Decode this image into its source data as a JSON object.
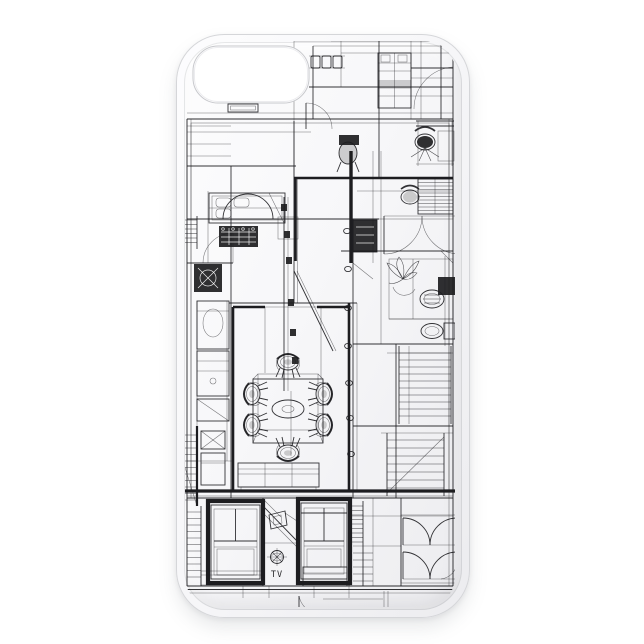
{
  "meta": {
    "description": "Product photo of a slim white phone case printed with a black and white architectural CAD wireframe floor plan drawing"
  },
  "theme": {
    "bg": "#ffffff",
    "ink": "#1d1d20",
    "case-surface": "#f7f7f9",
    "case-edge": "#d5d6d9",
    "cutout-outline": "#c7c8cc"
  },
  "print": {
    "tv_label": "TV"
  }
}
